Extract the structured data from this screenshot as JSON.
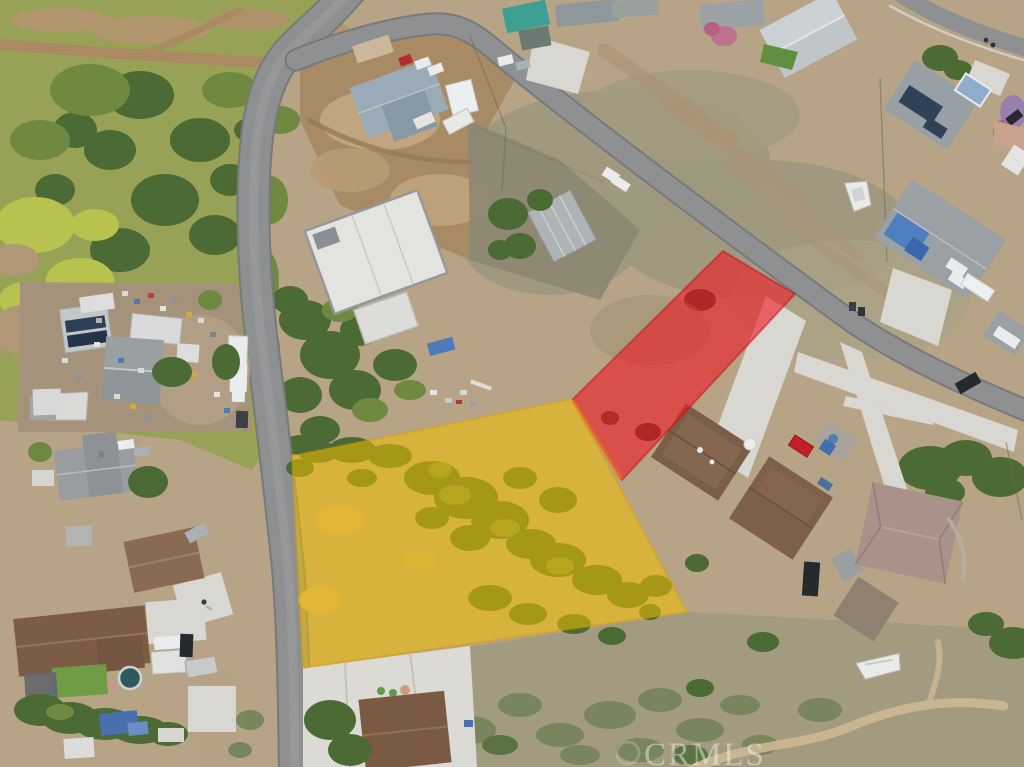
{
  "photo": {
    "kind": "aerial-drone-photo-with-parcel-highlights",
    "watermark": {
      "text": "CRMLS",
      "color": "#ffffff",
      "opacity": 0.42
    },
    "overlays": {
      "red": {
        "name": "red-highlighted-lot",
        "color": "#ed1b24",
        "opacity": 0.62,
        "points": "573,399 723,251 795,294 622,480"
      },
      "yellow": {
        "name": "yellow-highlighted-lot",
        "color": "#f2bd00",
        "opacity": 0.55,
        "points": "292,456 572,399 687,612 303,668"
      },
      "overlap_seam_color": "#f08020"
    },
    "palette": {
      "ground": "#b7a487",
      "dry_field": "#9d987e",
      "dirt_lot": "#a88a64",
      "scrub": "#a39b7f",
      "asphalt": "#8d8f90",
      "dirt_road": "#ab8a63",
      "concrete": "#d8d7d1",
      "veg_dark": "#4b6a34",
      "veg_mid": "#6f8a40",
      "veg_bright": "#b8c34f"
    }
  }
}
